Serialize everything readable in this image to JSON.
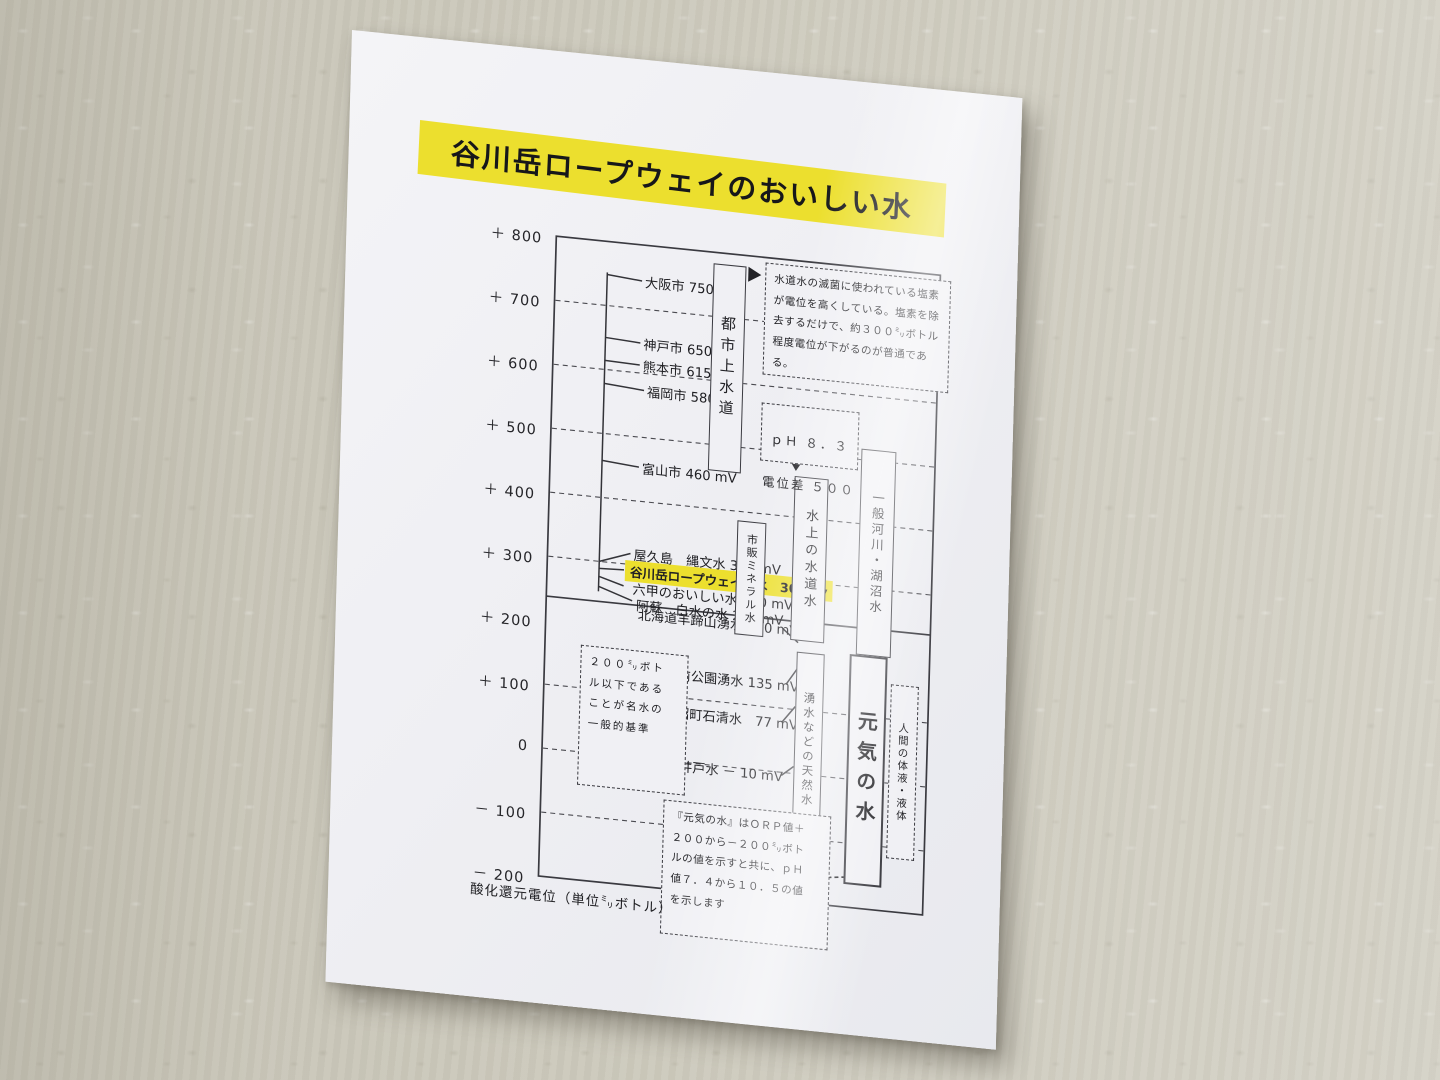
{
  "colors": {
    "highlight_yellow": "#ecdf2e",
    "title_bg": "#ecdf2e",
    "ink": "#222226"
  },
  "title": "谷川岳ロープウェイのおいしい水",
  "y_axis": {
    "ticks": [
      "＋ 800",
      "＋ 700",
      "＋ 600",
      "＋ 500",
      "＋ 400",
      "＋ 300",
      "＋ 200",
      "＋ 100",
      "0",
      "－ 100",
      "－ 200"
    ],
    "caption": "酸化還元電位（単位㍉ボトル）"
  },
  "upper_group": {
    "band_label": "都市上水道",
    "items": [
      "大阪市 750 mV",
      "神戸市 650 mV",
      "熊本市 615 mV",
      "福岡市 580 mV",
      "富山市 460 mV"
    ]
  },
  "mineral_group": {
    "band_label": "市販ミネラル水",
    "items": [
      "屋久島　縄文水 300 mV",
      "谷川岳ロープウェイの水　300mv",
      "六甲のおいしい水 270 mV",
      "阿蘇　白水の水 265 mV"
    ],
    "highlighted_item": "谷川岳ロープウェイの水　300mv"
  },
  "lower_group": {
    "band_label": "湧水などの天然水",
    "items": [
      "北海道羊蹄山湧水 220 mV",
      "水前寺前公園湧水 135 mV",
      "田沼町石清水　77 mV",
      "富山市井戸水 － 10 mV"
    ]
  },
  "bands": {
    "minakami_tap": "水上の水道水",
    "rivers": "一般河川・湖沼水",
    "genki": "元気の水",
    "human_fluids": "人間の体液・液体"
  },
  "notes": {
    "chlorine": "水道水の滅菌に使われている塩素\nが電位を高くしている。塩素を除\n去するだけで、約３００㍉ボトル\n程度電位が下がるのが普通である。",
    "ph_line1": "ｐＨ ８．３",
    "ph_line2": "電位差 ５００",
    "meisui": "２００㍉ボト\nル以下である\nことが名水の\n一般的基準",
    "genki": "『元気の水』はＯＲＰ値＋\n２００から－２００㍉ボト\nルの値を示すと共に、ｐＨ\n値７．４から１０．５の値\nを示します"
  },
  "chart_data": {
    "type": "scatter",
    "title": "谷川岳ロープウェイのおいしい水",
    "ylabel": "酸化還元電位（単位㍉ボトル）",
    "ylim": [
      -200,
      800
    ],
    "ytick_step": 100,
    "grid": "dashed horizontal lines every 100 mV; solid divider near +240",
    "series": [
      {
        "name": "都市上水道",
        "points": [
          {
            "label": "大阪市",
            "mv": 750
          },
          {
            "label": "神戸市",
            "mv": 650
          },
          {
            "label": "熊本市",
            "mv": 615
          },
          {
            "label": "福岡市",
            "mv": 580
          },
          {
            "label": "富山市",
            "mv": 460
          }
        ]
      },
      {
        "name": "市販ミネラル水",
        "points": [
          {
            "label": "屋久島 縄文水",
            "mv": 300
          },
          {
            "label": "谷川岳ロープウェイの水",
            "mv": 300,
            "highlight": true
          },
          {
            "label": "六甲のおいしい水",
            "mv": 270
          },
          {
            "label": "阿蘇 白水の水",
            "mv": 265
          }
        ]
      },
      {
        "name": "湧水などの天然水",
        "points": [
          {
            "label": "北海道羊蹄山湧水",
            "mv": 220
          },
          {
            "label": "水前寺前公園湧水",
            "mv": 135
          },
          {
            "label": "田沼町石清水",
            "mv": 77
          },
          {
            "label": "富山市井戸水",
            "mv": -10
          }
        ]
      }
    ],
    "range_bands": [
      {
        "label": "都市上水道",
        "from": 470,
        "to": 790
      },
      {
        "label": "市販ミネラル水",
        "from": 230,
        "to": 390
      },
      {
        "label": "水上の水道水",
        "from": 235,
        "to": 470
      },
      {
        "label": "一般河川・湖沼水",
        "from": 225,
        "to": 520
      },
      {
        "label": "湧水などの天然水",
        "from": -110,
        "to": 235
      },
      {
        "label": "元気の水",
        "from": -190,
        "to": 230
      },
      {
        "label": "人間の体液・液体",
        "from": -140,
        "to": 120
      }
    ],
    "annotations": [
      "水道水の滅菌に使われている塩素が電位を高くしている。塩素を除去するだけで、約３００㍉ボトル程度電位が下がるのが普通である。",
      "ｐＨ ８．３ 電位差 ５００",
      "２００㍉ボトル以下であることが名水の一般的基準",
      "『元気の水』はＯＲＰ値＋２００から－２００㍉ボトルの値を示すと共に、ｐＨ値７．４から１０．５の値を示します"
    ]
  }
}
